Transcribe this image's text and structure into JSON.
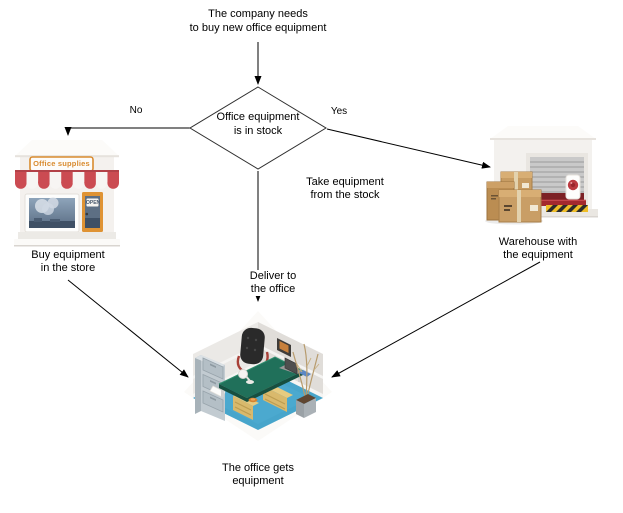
{
  "diagram": {
    "title": {
      "line1": "The company needs",
      "line2": "to buy new office equipment"
    },
    "decision": {
      "line1": "Office equipment",
      "line2": "is in stock"
    },
    "branch_labels": {
      "no": "No",
      "yes": "Yes"
    },
    "path_labels": {
      "warehouse_path": {
        "line1": "Take equipment",
        "line2": "from the stock"
      },
      "store_path": {
        "line1": "Buy equipment",
        "line2": "in the store"
      },
      "deliver_path": {
        "line1": "Deliver to",
        "line2": "the office"
      }
    },
    "captions": {
      "warehouse": {
        "line1": "Warehouse with",
        "line2": "the equipment"
      },
      "office": {
        "line1": "The office gets",
        "line2": "equipment"
      }
    },
    "store_node": {
      "sign": "Office supplies",
      "door_sign": "OPEN"
    },
    "colors": {
      "awning_red": "#cb4b52",
      "sign_orange": "#d98b2f",
      "carpet_blue": "#47a5cb",
      "desk_green": "#20705a",
      "box_tan": "#c79c63",
      "warehouse_red": "#a3282e",
      "hazard_yellow": "#eebd27",
      "connector": "#000000"
    }
  }
}
